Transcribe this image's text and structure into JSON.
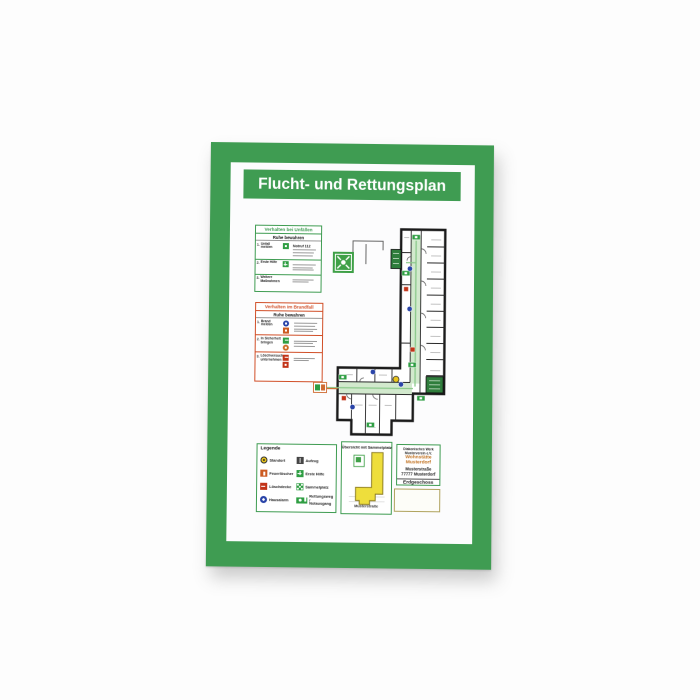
{
  "frame": {
    "title": "Flucht- und Rettungsplan",
    "color_green": "#3f9c52"
  },
  "accident": {
    "title": "Verhalten bei Unfällen",
    "subtitle": "Ruhe bewahren",
    "rows": [
      {
        "num": "1.",
        "label": "Unfall melden",
        "note": "Notruf 112",
        "icon": "phone-green-icon"
      },
      {
        "num": "2.",
        "label": "Erste Hilfe",
        "note": "",
        "icon": "first-aid-cross-icon"
      },
      {
        "num": "3.",
        "label": "Weitere Maßnahmen",
        "note": "",
        "icon": ""
      }
    ]
  },
  "fire": {
    "title": "Verhalten im Brandfall",
    "subtitle": "Ruhe bewahren",
    "rows": [
      {
        "num": "1.",
        "label": "Brand melden",
        "icon": "alarm-button-and-phone-icons"
      },
      {
        "num": "2.",
        "label": "In Sicherheit bringen",
        "icon": "emergency-exit-and-direction-icons"
      },
      {
        "num": "3.",
        "label": "Löschversuch unternehmen",
        "icon": "fire-extinguisher-icons"
      }
    ]
  },
  "legend": {
    "title": "Legende",
    "left": [
      {
        "label": "Standort",
        "icon": "location-marker-icon"
      },
      {
        "label": "Feuerlöscher",
        "icon": "fire-extinguisher-icon"
      },
      {
        "label": "Löschdecke",
        "icon": "fire-blanket-icon"
      },
      {
        "label": "Hausalarm",
        "icon": "house-alarm-icon"
      }
    ],
    "right": [
      {
        "label": "Aufzug",
        "icon": "elevator-icon"
      },
      {
        "label": "Erste Hilfe",
        "icon": "first-aid-icon"
      },
      {
        "label": "Sammelplatz",
        "icon": "assembly-point-icon"
      },
      {
        "label1": "Rettungsweg /",
        "label2": "Notausgang",
        "icon": "escape-route-icon"
      }
    ]
  },
  "overview": {
    "title": "Übersicht mit Sammelplatz",
    "street": "Musterstraße",
    "building_fill": "#eede3c"
  },
  "info": {
    "org1": "Diakonisches Werk",
    "org2": "Musterverein e.V.",
    "name1": "Wohnstätte",
    "name2": "Musterdorf",
    "street": "Musterstraße",
    "city": "77777 Musterdorf",
    "floor": "Erdgeschoss",
    "accent_color": "#c0701e"
  },
  "plan_colors": {
    "escape_route": "#d2e9cd",
    "safety_green": "#2f9e43",
    "stairs_green": "#2f7d3c",
    "signal_red": "#c23318",
    "alarm_blue": "#2a44a8",
    "standort_yellow": "#e8c41e",
    "exit_arrow_orange": "#cf6a30"
  }
}
